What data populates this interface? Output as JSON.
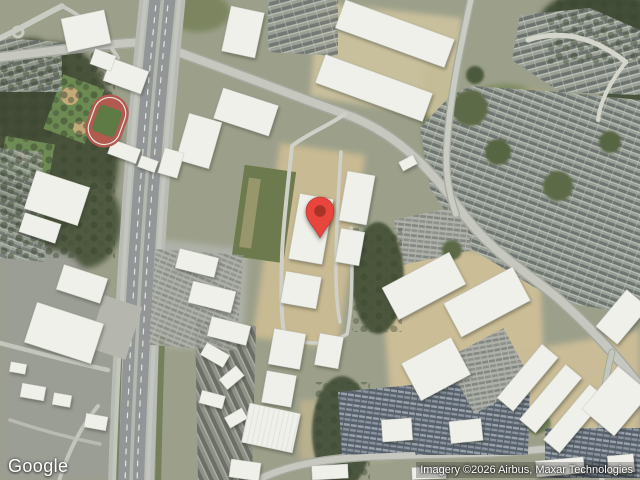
{
  "map": {
    "type": "satellite",
    "overlays": {
      "logo": "Google",
      "attribution": "Imagery ©2026 Airbus, Maxar Technologies"
    },
    "marker": {
      "name": "location-pin",
      "shape": "google-maps-pin"
    },
    "colors": {
      "marker": "#E8453C",
      "marker-inner": "#A93226",
      "logo-text": "#FFFFFF",
      "attribution-text": "#FFFFFF"
    }
  }
}
